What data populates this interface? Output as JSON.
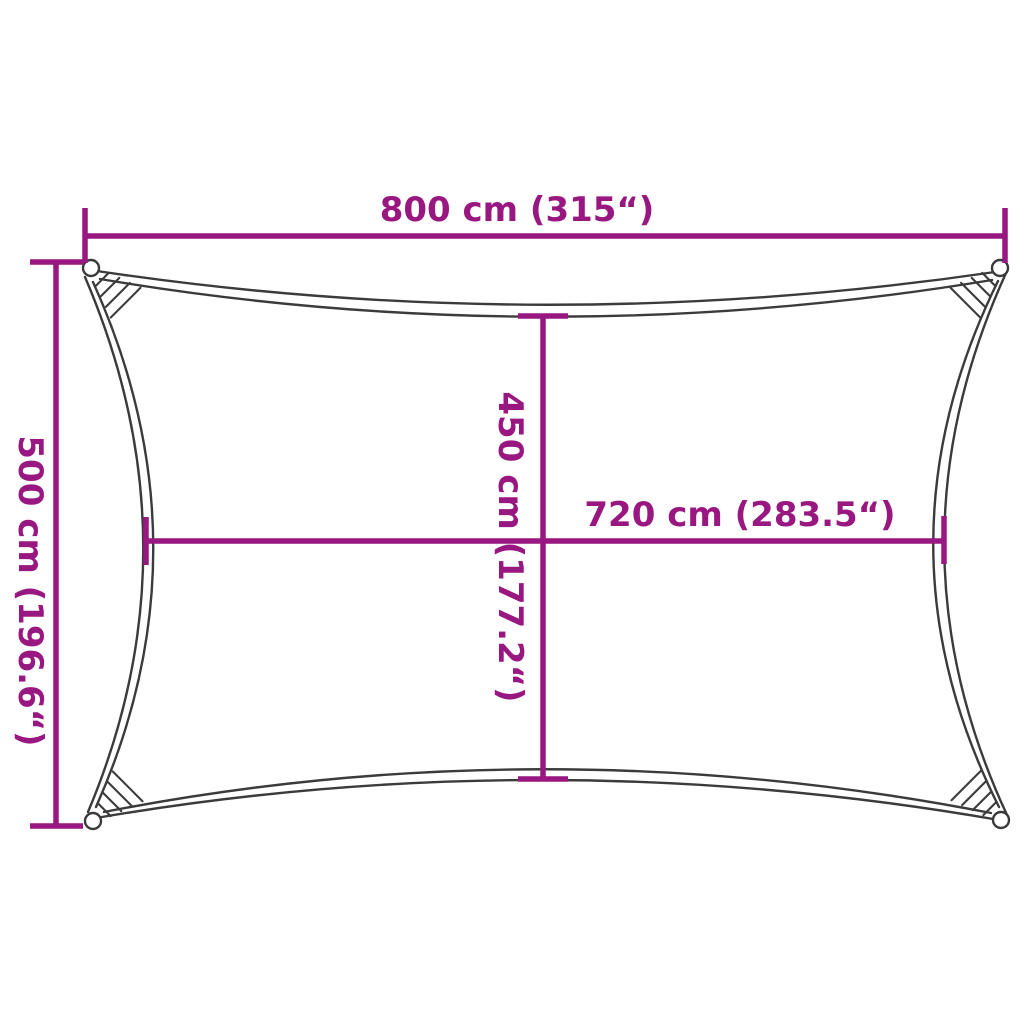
{
  "diagram": {
    "kind": "product-dimension-diagram",
    "subject": "rectangular shade sail top view",
    "colors": {
      "dimension_accent": "#991780",
      "outline": "#3b3b3b",
      "background": "#ffffff"
    },
    "dimensions": {
      "top_width": {
        "label": "800 cm (315“)",
        "value_cm": 800,
        "value_in": 315
      },
      "left_height": {
        "label": "500 cm (196.6“)",
        "value_cm": 500,
        "value_in": 196.6
      },
      "inner_height": {
        "label": "450 cm (177.2“)",
        "value_cm": 450,
        "value_in": 177.2
      },
      "inner_width": {
        "label": "720 cm (283.5“)",
        "value_cm": 720,
        "value_in": 283.5
      }
    }
  }
}
